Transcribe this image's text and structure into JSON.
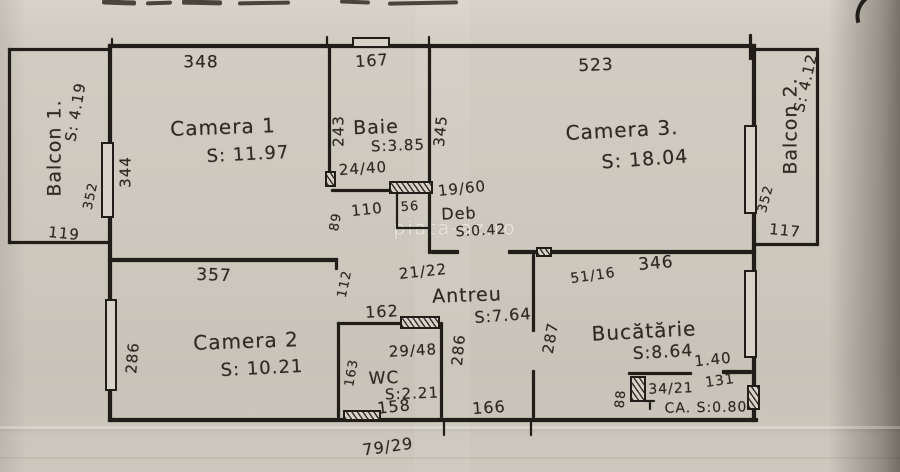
{
  "watermark": "piata-az.ro",
  "rooms": {
    "camera1": {
      "label": "Camera 1",
      "area": "S: 11.97"
    },
    "camera2": {
      "label": "Camera 2",
      "area": "S: 10.21"
    },
    "camera3": {
      "label": "Camera 3.",
      "area": "S: 18.04"
    },
    "baie": {
      "label": "Baie",
      "area": "S:3.85"
    },
    "wc": {
      "label": "WC",
      "area": "S:2.21"
    },
    "antreu": {
      "label": "Antreu",
      "area": "S:7.64"
    },
    "bucatarie": {
      "label": "Bucătărie",
      "area": "S:8.64"
    },
    "deb": {
      "label": "Deb",
      "area": "S:0.42"
    },
    "camara": {
      "label": "CA. S:0.80"
    },
    "balcon1": {
      "label": "Balcon 1.",
      "area": "S: 4.19"
    },
    "balcon2": {
      "label": "Balcon 2.",
      "area": "S: 4.12"
    }
  },
  "dims": {
    "c1_top": "348",
    "baie_top": "167",
    "c3_top": "523",
    "c1_left": "344",
    "b1_win": "352",
    "b1_bottom": "119",
    "baie_left": "243",
    "baie_right": "345",
    "baie_door": "24/40",
    "deb_win": "19/60",
    "w110": "110",
    "w56": "56",
    "h89": "89",
    "door_2122": "21/22",
    "h112": "112",
    "c2_top": "357",
    "c2_left": "286",
    "antreu_right": "286",
    "kitchen_left": "287",
    "wc_top": "162",
    "wc_win": "29/48",
    "wc_left": "163",
    "wc_bottom": "158",
    "wc_door": "79/29",
    "antreu_bottom": "166",
    "kitchen_top": "346",
    "kitchen_door": "51/16",
    "pantry_door": "1.40",
    "pantry_win": "34/21",
    "pantry_w": "131",
    "pantry_h": "88",
    "b2_win": "352",
    "b2_bottom": "117"
  },
  "colors": {
    "ink": "#211e19",
    "paper": "#cfcabf"
  }
}
